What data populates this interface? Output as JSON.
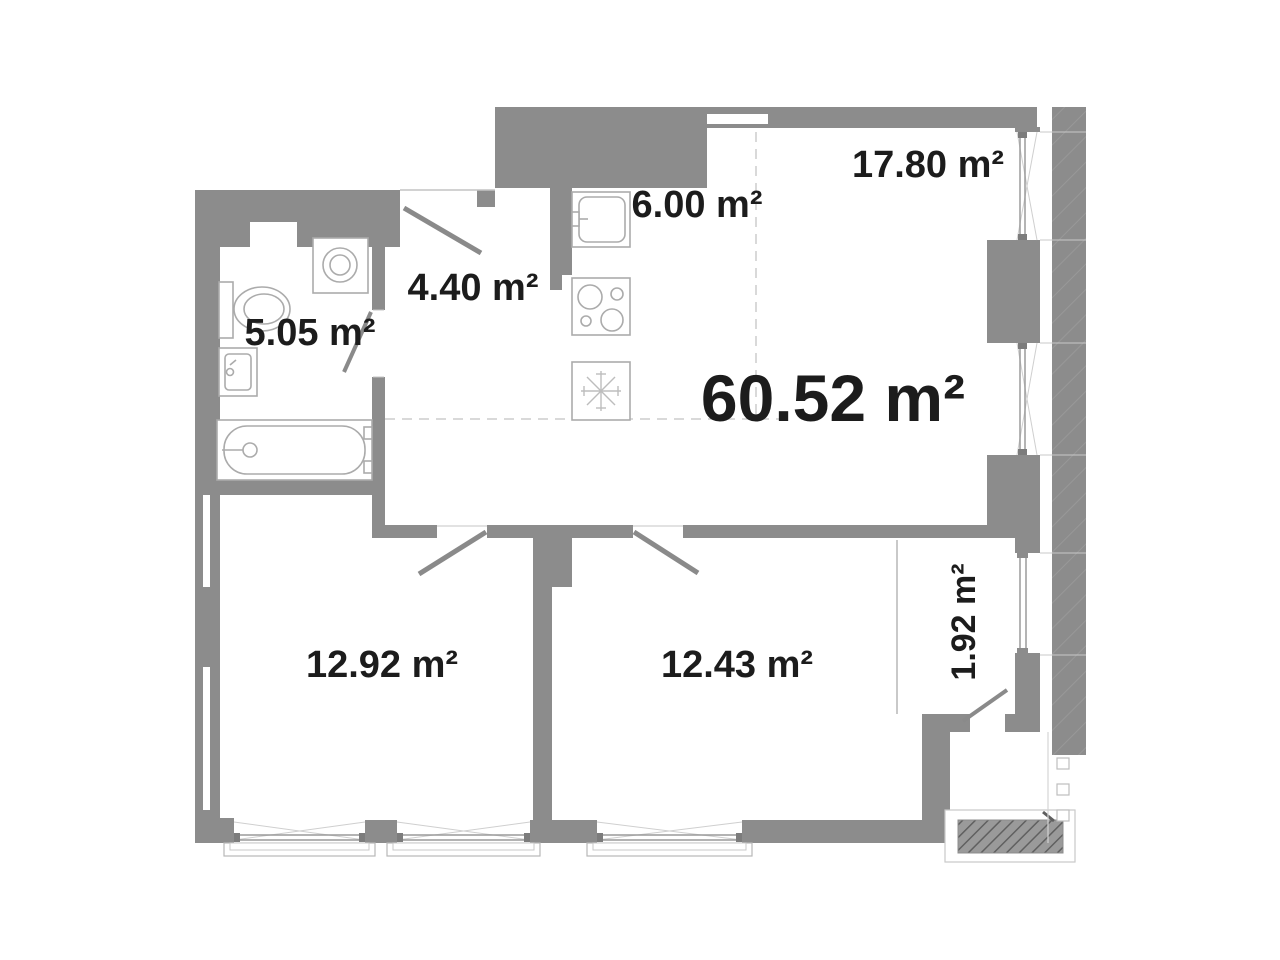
{
  "plan": {
    "title": "apartment-floor-plan",
    "total_area_label": "60.52 m²",
    "rooms": [
      {
        "name": "bathroom",
        "area_label": "5.05 m²"
      },
      {
        "name": "hallway",
        "area_label": "4.40 m²"
      },
      {
        "name": "kitchen",
        "area_label": "6.00 m²"
      },
      {
        "name": "living-room",
        "area_label": "17.80 m²"
      },
      {
        "name": "bedroom-1",
        "area_label": "12.92 m²"
      },
      {
        "name": "bedroom-2",
        "area_label": "12.43 m²"
      },
      {
        "name": "loggia",
        "area_label": "1.92 m²"
      }
    ],
    "fixtures": [
      "toilet",
      "bathroom-sink",
      "washing-machine",
      "bathtub",
      "kitchen-sink",
      "cooktop",
      "refrigerator"
    ],
    "colors": {
      "wall": "#8c8c8c",
      "fixture_outline": "#ababab",
      "light_line": "#c9c9c9",
      "text": "#1c1c1c",
      "background": "#ffffff"
    }
  }
}
